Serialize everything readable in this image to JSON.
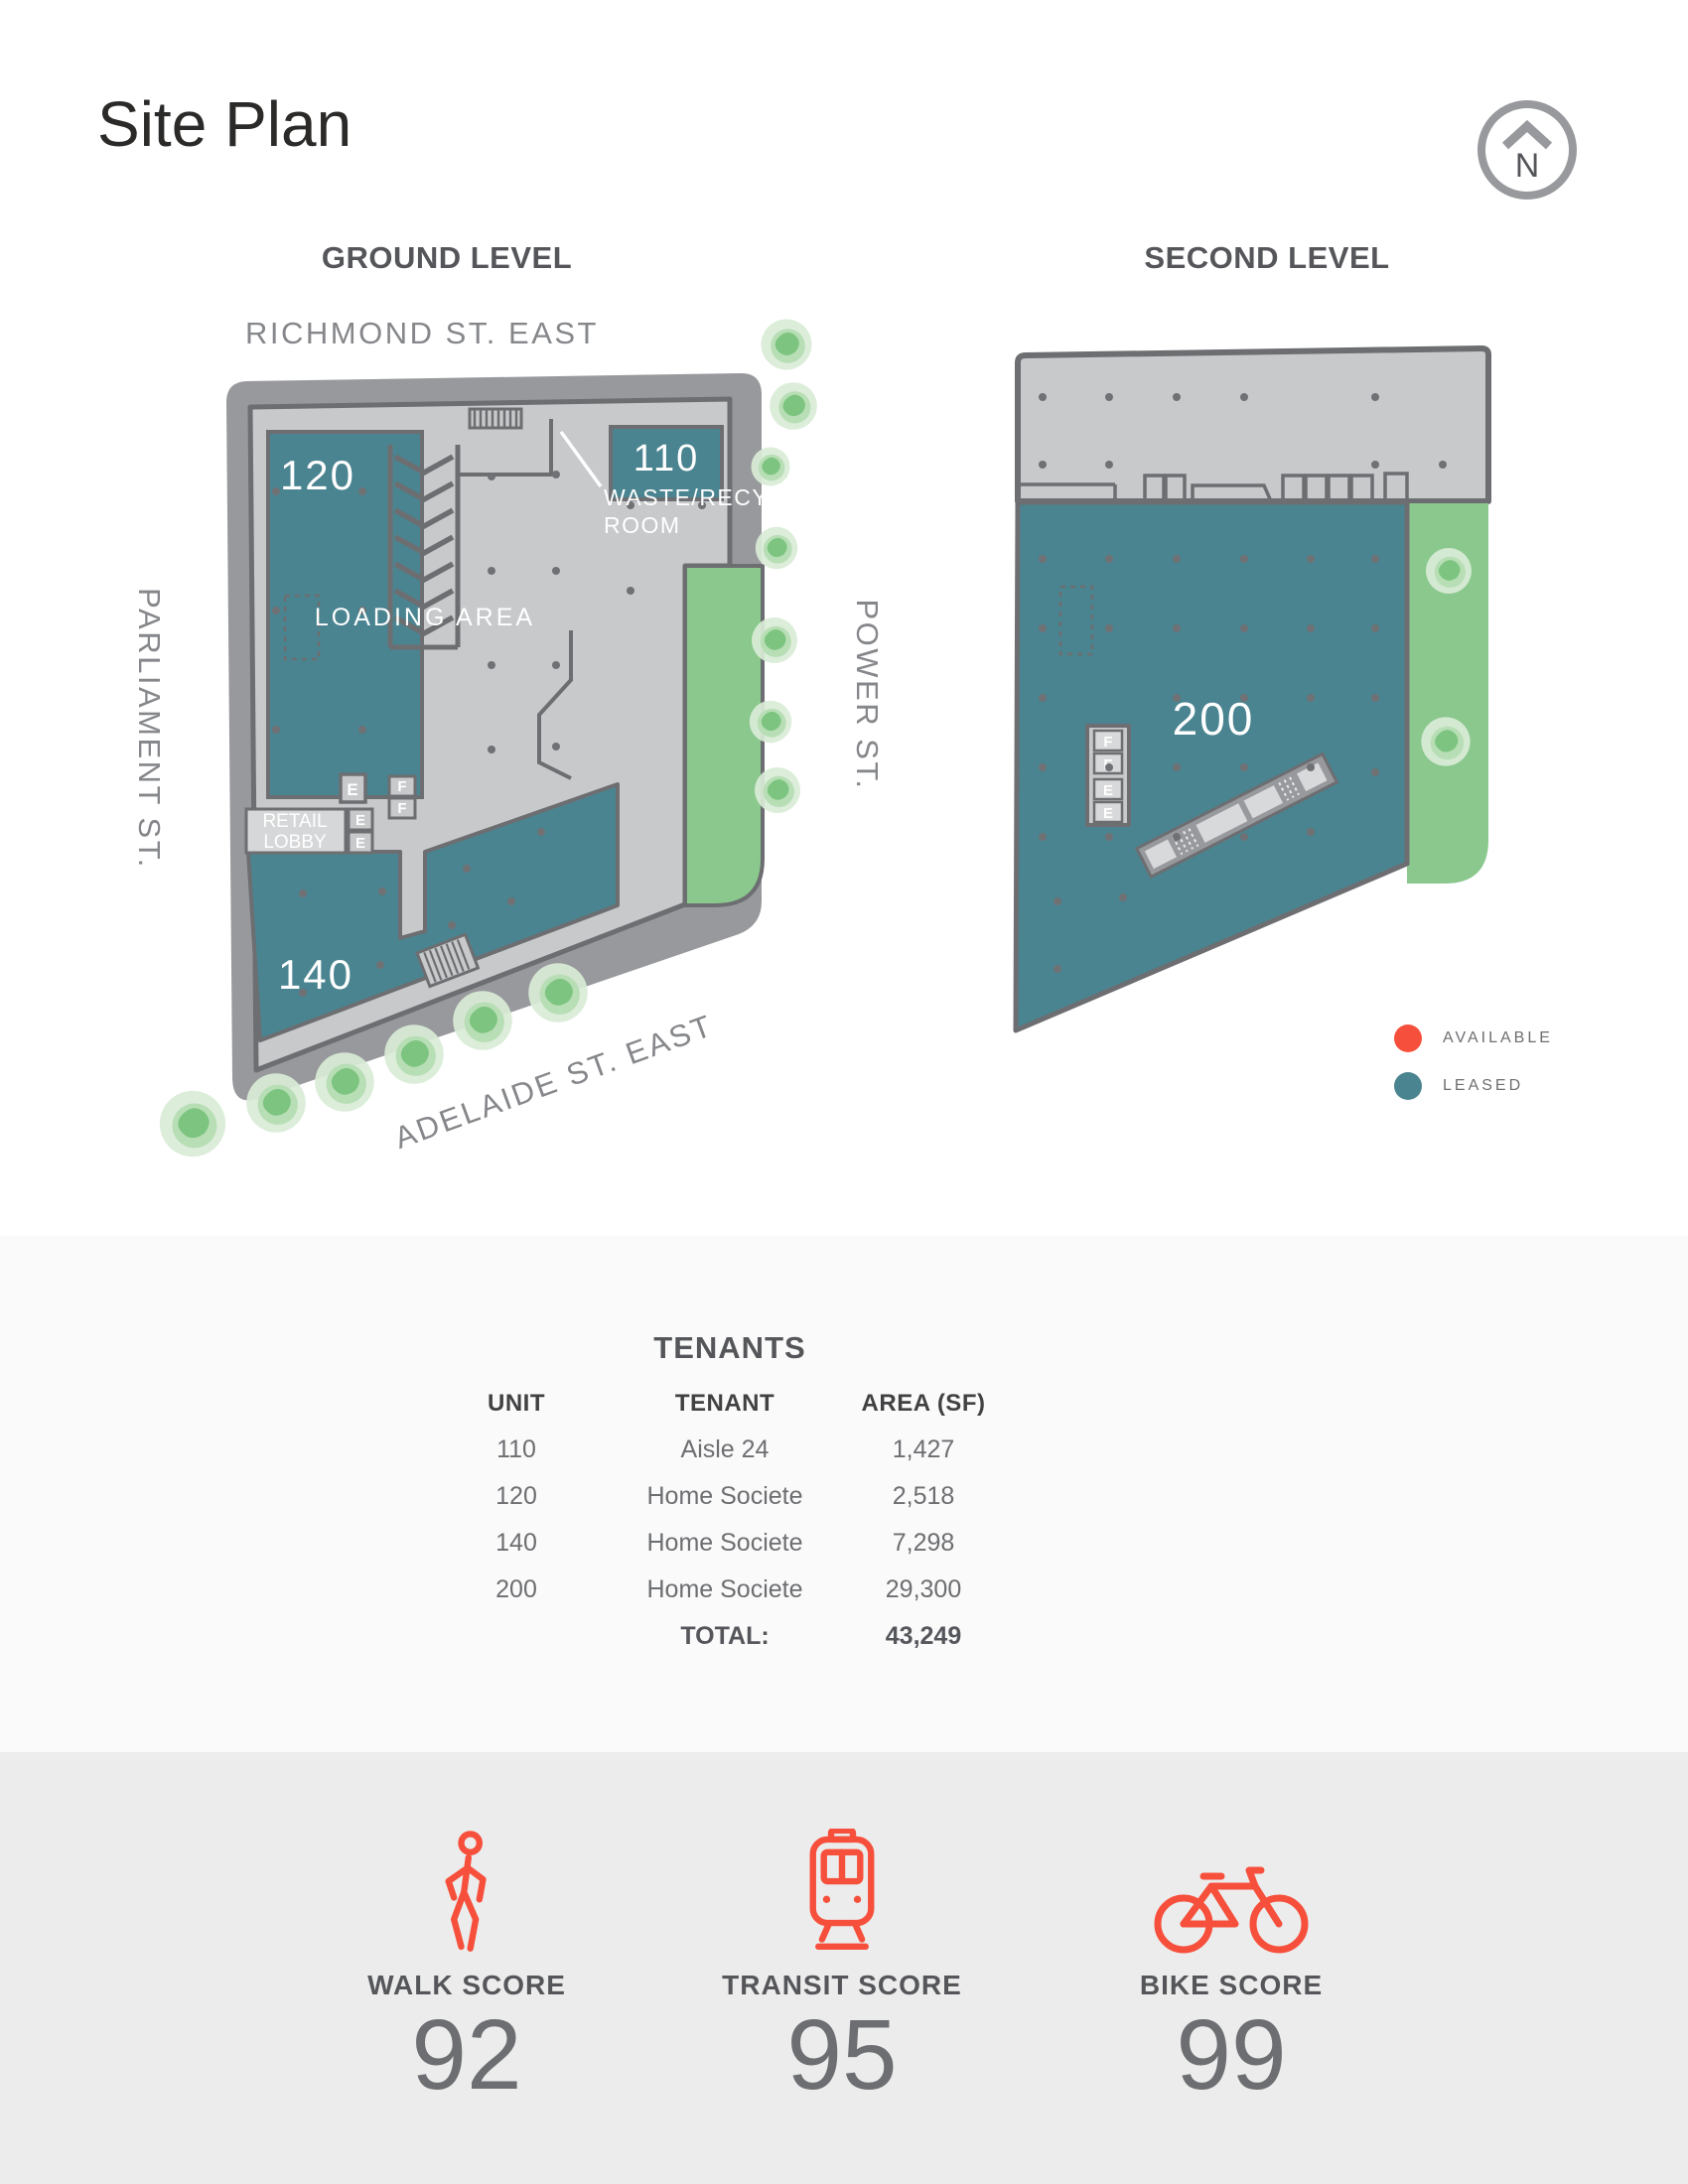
{
  "title": "Site Plan",
  "compass": {
    "letter": "N"
  },
  "plans": {
    "ground": {
      "heading": "GROUND LEVEL",
      "street_top": "RICHMOND ST. EAST",
      "street_left": "PARLIAMENT ST.",
      "street_right": "POWER ST.",
      "street_bottom": "ADELAIDE ST. EAST",
      "unit_110": "110",
      "unit_120": "120",
      "unit_140": "140",
      "waste_line1": "WASTE/RECYCLE",
      "waste_line2": "ROOM",
      "loading": "LOADING AREA",
      "retail_line1": "RETAIL",
      "retail_line2": "LOBBY",
      "stair_e": "E",
      "stair_f": "F"
    },
    "second": {
      "heading": "SECOND LEVEL",
      "unit_200": "200",
      "stair_e": "E",
      "stair_f": "F"
    }
  },
  "legend": {
    "available": "AVAILABLE",
    "leased": "LEASED",
    "available_color": "#f6503c",
    "leased_color": "#4a8490"
  },
  "tenants": {
    "title": "TENANTS",
    "columns": [
      "UNIT",
      "TENANT",
      "AREA (SF)"
    ],
    "rows": [
      [
        "110",
        "Aisle 24",
        "1,427"
      ],
      [
        "120",
        "Home Societe",
        "2,518"
      ],
      [
        "140",
        "Home Societe",
        "7,298"
      ],
      [
        "200",
        "Home Societe",
        "29,300"
      ]
    ],
    "total_label": "TOTAL:",
    "total_value": "43,249"
  },
  "scores": {
    "walk": {
      "label": "WALK SCORE",
      "value": "92"
    },
    "transit": {
      "label": "TRANSIT SCORE",
      "value": "95"
    },
    "bike": {
      "label": "BIKE SCORE",
      "value": "99"
    }
  }
}
